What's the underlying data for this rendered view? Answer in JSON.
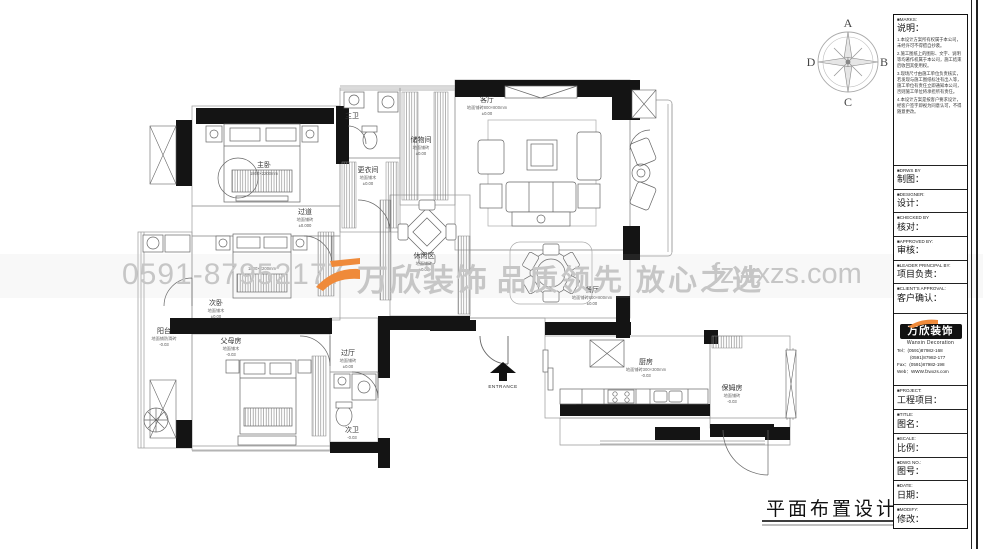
{
  "watermark": {
    "phone": "0591-87952177",
    "brand": "万欣装饰",
    "slogan": "品质领先 放心之选",
    "website": "fzwxzs.com"
  },
  "compass": {
    "north": "A",
    "east": "B",
    "south": "C",
    "west": "D"
  },
  "sheet_title": "平面布置设计图",
  "entrance_label": "ENTRANCE",
  "annotations": {
    "bed_dim_second": "1800×2200mm"
  },
  "rooms": [
    {
      "label": "主卧",
      "sub": "1800×2200mm",
      "elev": ""
    },
    {
      "label": "更衣间",
      "sub": "地面铺木",
      "elev": "±0.00"
    },
    {
      "label": "主卫",
      "sub": "地面铺砖",
      "elev": "-0.03"
    },
    {
      "label": "储物间",
      "sub": "地面铺砖",
      "elev": "±0.00"
    },
    {
      "label": "客厅",
      "sub": "地面铺砖800×800mm",
      "elev": "±0.00"
    },
    {
      "label": "休闲区",
      "sub": "地面铺砖",
      "elev": "±0.00"
    },
    {
      "label": "餐厅",
      "sub": "地面铺砖800×800mm",
      "elev": "±0.00"
    },
    {
      "label": "过道",
      "sub": "地面铺砖",
      "elev": "±0.000"
    },
    {
      "label": "次卧",
      "sub": "地面铺木",
      "elev": "±0.00"
    },
    {
      "label": "阳台",
      "sub": "地面铺防滑砖",
      "elev": "-0.03"
    },
    {
      "label": "父母房",
      "sub": "地面铺木",
      "elev": "-0.03"
    },
    {
      "label": "过厅",
      "sub": "地面铺砖",
      "elev": "±0.00"
    },
    {
      "label": "次卫",
      "sub": "地面铺砖",
      "elev": "-0.03"
    },
    {
      "label": "厨房",
      "sub": "地面铺砖300×300mm",
      "elev": "-0.03"
    },
    {
      "label": "保姆房",
      "sub": "地面铺砖",
      "elev": "-0.03"
    }
  ],
  "title_block": {
    "marks_en": "■MARKS:",
    "marks_cn": "说明：",
    "notes": [
      "1.本设计方案所有权属于本公司，未经许可不得擅自抄袭。",
      "2.施工图纸上的图形、文字、说明等均著作权属于本公司，施工结束后收回其使用权。",
      "3.现场尺寸由施工单位负责核实，若发现与施工图纸标注有出入等，施工单位有责任立即通知本公司，否则施工单位将承担所有责任。",
      "4.本设计方案是按客户要求设计，经客户签字即视为同意认可，不得随意更改。"
    ],
    "fields": [
      {
        "en": "■DRWS BY",
        "cn": "制图："
      },
      {
        "en": "■DESIGNER:",
        "cn": "设计："
      },
      {
        "en": "■CHECKED BY",
        "cn": "核对："
      },
      {
        "en": "■APPROVED BY:",
        "cn": "审核："
      },
      {
        "en": "■LEADER PRINCIPAL BY:",
        "cn": "项目负责："
      },
      {
        "en": "■CLIENT'S APPROVAL:",
        "cn": "客户确认："
      }
    ],
    "company": {
      "logo_text": "万欣装饰",
      "logo_sub": "Wanxin Decoration",
      "tel1": "Tel：(0591)87982-168",
      "tel2": "(0591)87982-177",
      "fax": "Fax：(0591)87982-198",
      "web": "Web：WWW.fzwxzs.com"
    },
    "fields2": [
      {
        "en": "■PROJECT:",
        "cn": "工程项目："
      },
      {
        "en": "■TITLE:",
        "cn": "图名："
      },
      {
        "en": "■SCALE:",
        "cn": "比例："
      },
      {
        "en": "■DWG NO.:",
        "cn": "图号："
      },
      {
        "en": "■DATE:",
        "cn": "日期："
      },
      {
        "en": "■MODIFY:",
        "cn": "修改："
      }
    ]
  }
}
